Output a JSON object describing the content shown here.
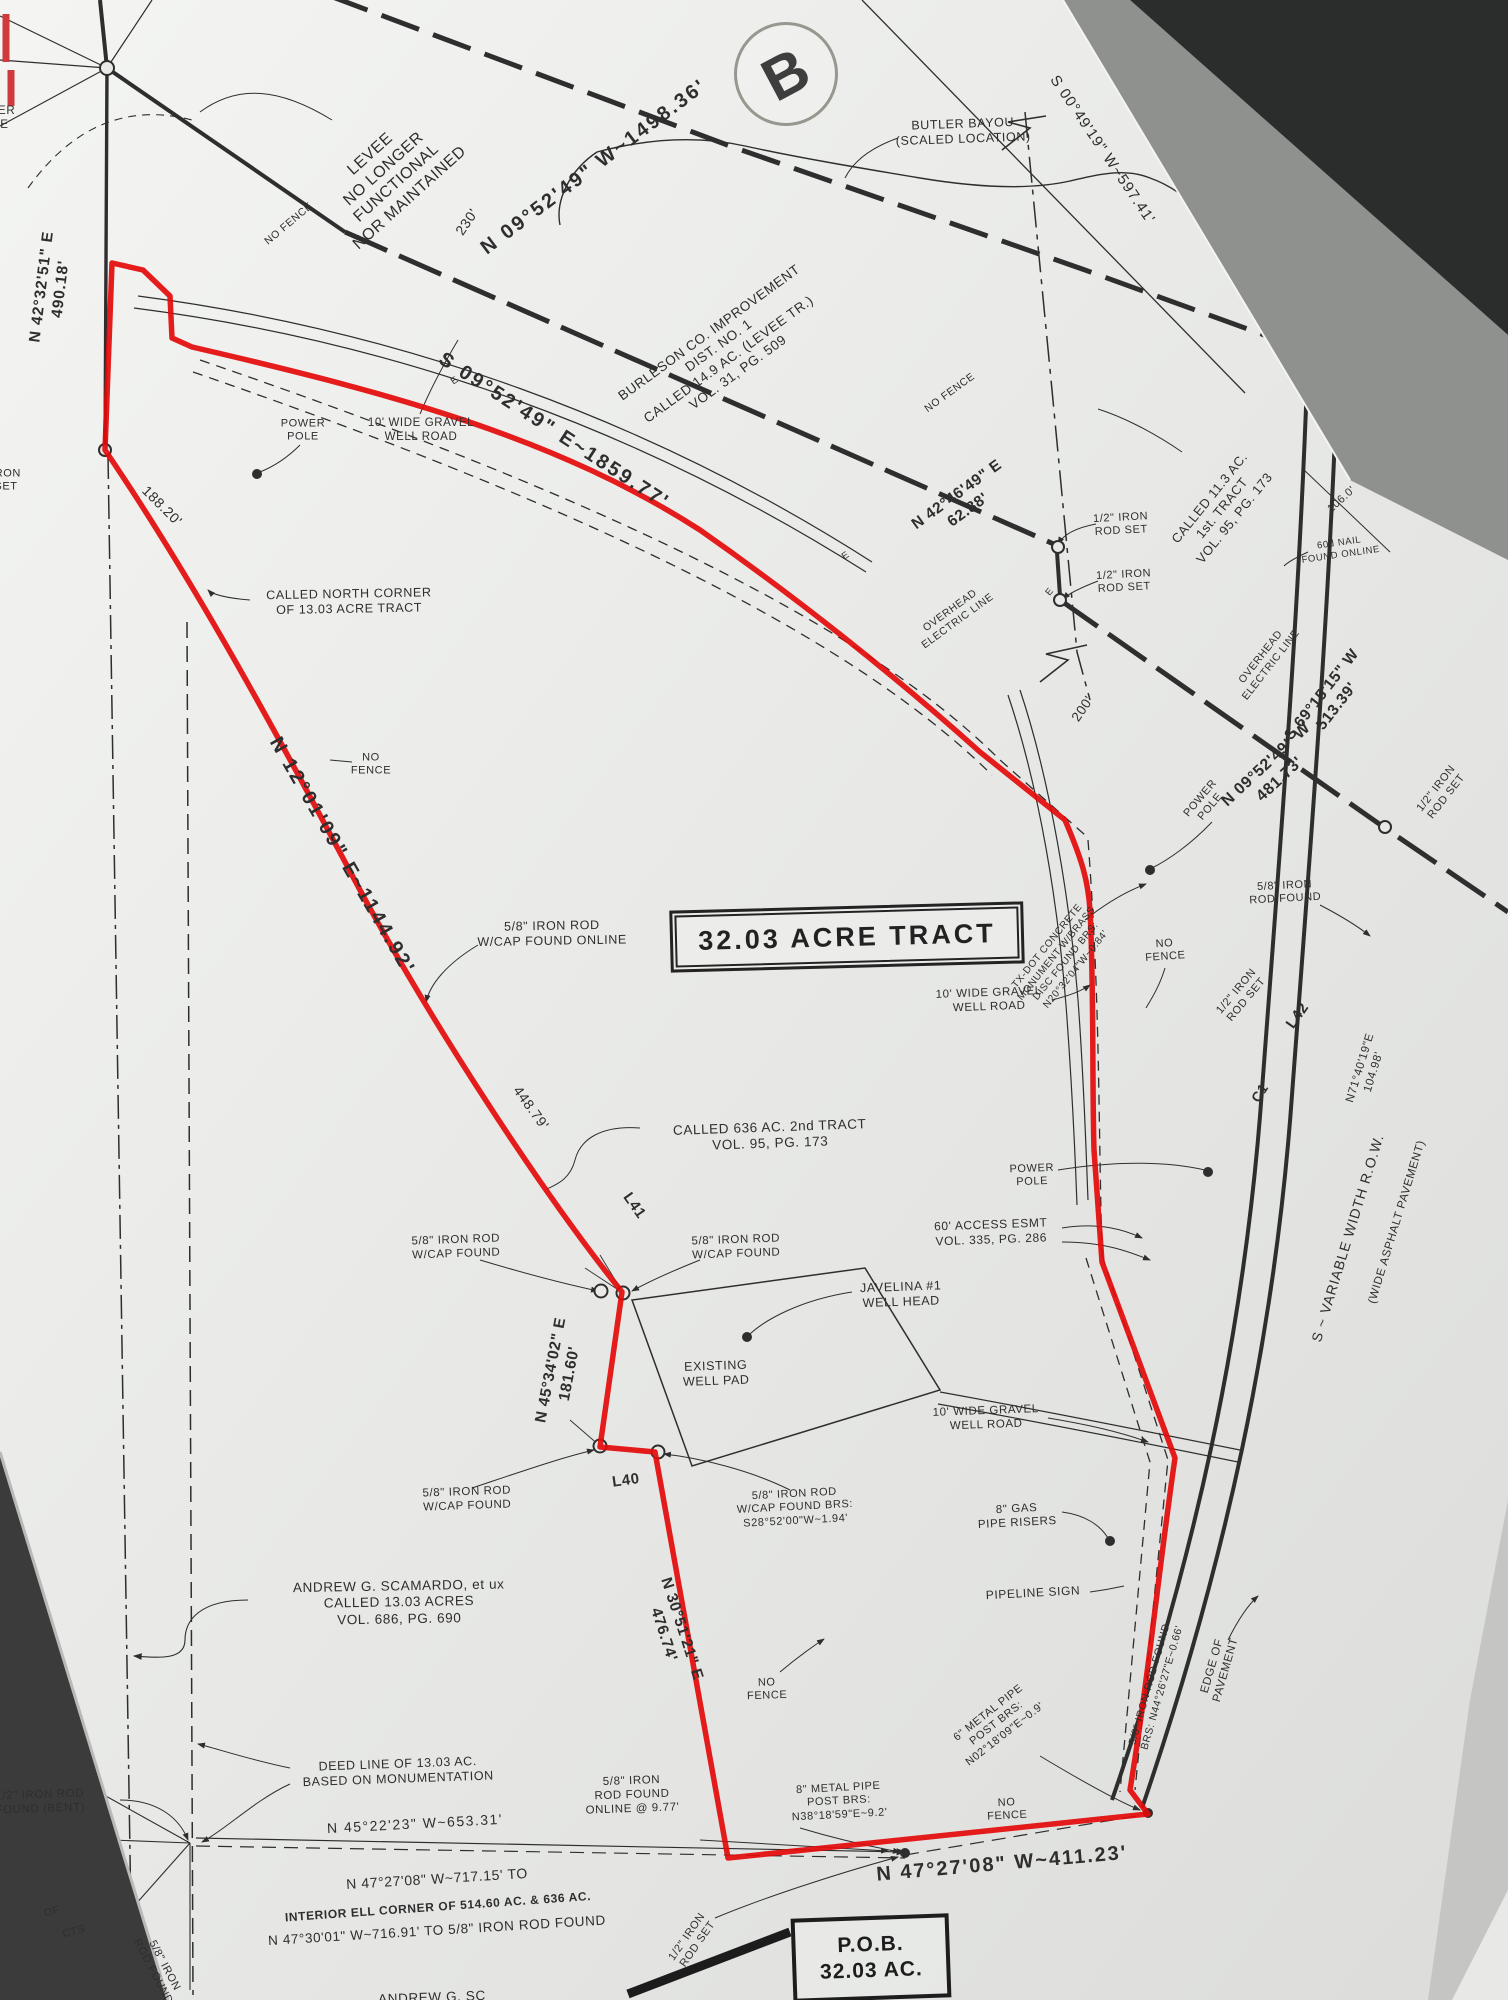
{
  "meta": {
    "kind": "scanned land survey plat photograph",
    "subject_tract": "32.03 ACRE TRACT"
  },
  "colors": {
    "paper": "#e9eae8",
    "ink": "#2e2e2e",
    "boundary_red": "#e40a0a",
    "background_dark": "#2b2c2c"
  },
  "boxes": {
    "tract_title": "32.03 ACRE TRACT",
    "pob_line1": "P.O.B.",
    "pob_line2": "32.03 AC.",
    "stamp": "B"
  },
  "labels": [
    {
      "name": "power-pole-clipped",
      "text": "POWER\nPOLE",
      "x": -8,
      "y": 118,
      "rot": 0,
      "size": 11.5
    },
    {
      "name": "bearing-n4232",
      "text": "N 42°32'51\" E\n490.18'",
      "x": 52,
      "y": 288,
      "rot": -83,
      "size": 15.5,
      "weight": 600,
      "ls": 1
    },
    {
      "name": "levee-note",
      "text": "LEVEE\nNO LONGER\nFUNCTIONAL\nNOR MAINTAINED",
      "x": 390,
      "y": 176,
      "rot": -42,
      "size": 16
    },
    {
      "name": "no-fence-1",
      "text": "NO FENCE",
      "x": 289,
      "y": 224,
      "rot": -40,
      "size": 10.5
    },
    {
      "name": "bearing-n0952-main",
      "text": "N 09°52'49\" W~1498.36'",
      "x": 594,
      "y": 167,
      "rot": -37,
      "size": 20,
      "weight": 600,
      "ls": 2.5
    },
    {
      "name": "dim-230",
      "text": "230'",
      "x": 467,
      "y": 222,
      "rot": -56,
      "size": 14
    },
    {
      "name": "butler-bayou",
      "text": "BUTLER BAYOU\n(SCALED LOCATION)",
      "x": 963,
      "y": 132,
      "rot": -2,
      "size": 12.5
    },
    {
      "name": "bearing-s0049",
      "text": "S 00°49'19\" W~597.41'",
      "x": 1102,
      "y": 150,
      "rot": 56,
      "size": 15,
      "ls": 1
    },
    {
      "name": "burleson-note",
      "text": "BURLESON CO. IMPROVEMENT\nDIST. NO. 1\nCALLED 14.9 AC. (LEVEE TR.)\nVOL. 31, PG. 509",
      "x": 724,
      "y": 353,
      "rot": -36,
      "size": 13.5
    },
    {
      "name": "no-fence-2",
      "text": "NO FENCE",
      "x": 950,
      "y": 393,
      "rot": -36,
      "size": 10.5
    },
    {
      "name": "bearing-n4246",
      "text": "N 42°46'49\" E\n62.88'",
      "x": 963,
      "y": 503,
      "rot": -36,
      "size": 15.5,
      "weight": 600
    },
    {
      "name": "overhead-electric-1",
      "text": "OVERHEAD\nELECTRIC LINE",
      "x": 954,
      "y": 616,
      "rot": -36,
      "size": 10.5
    },
    {
      "name": "bearing-s0952",
      "text": "S 09°52'49\" E~1859.77'",
      "x": 554,
      "y": 431,
      "rot": 33,
      "size": 20,
      "weight": 600,
      "ls": 2.5
    },
    {
      "name": "iron-rod-set-1",
      "text": "1/2\" IRON\nROD SET",
      "x": 1121,
      "y": 525,
      "rot": -3,
      "size": 11
    },
    {
      "name": "iron-rod-set-2",
      "text": "1/2\" IRON\nROD SET",
      "x": 1124,
      "y": 582,
      "rot": -3,
      "size": 11
    },
    {
      "name": "called-113",
      "text": "CALLED 11.3 AC.\n1st. TRACT\nVOL. 95, PG. 173",
      "x": 1222,
      "y": 508,
      "rot": -51,
      "size": 13
    },
    {
      "name": "nail-60d",
      "text": "60d NAIL\nFOUND ONLINE",
      "x": 1340,
      "y": 549,
      "rot": -8,
      "size": 9.5
    },
    {
      "name": "dim-106",
      "text": "106.0'",
      "x": 1342,
      "y": 500,
      "rot": -42,
      "size": 11
    },
    {
      "name": "bearing-s6915",
      "text": "S 69°15'15\" W\n513.39'",
      "x": 1330,
      "y": 701,
      "rot": -52,
      "size": 15.5,
      "weight": 600
    },
    {
      "name": "overhead-electric-2",
      "text": "OVERHEAD\nELECTRIC LINE",
      "x": 1266,
      "y": 661,
      "rot": -52,
      "size": 10.5
    },
    {
      "name": "dim-200",
      "text": "200'",
      "x": 1083,
      "y": 709,
      "rot": -56,
      "size": 13.5
    },
    {
      "name": "bearing-n0952-481",
      "text": "N 09°52'49\" W\n481.73'",
      "x": 1273,
      "y": 772,
      "rot": -43,
      "size": 16,
      "weight": 600
    },
    {
      "name": "power-pole-2",
      "text": "POWER\nPOLE",
      "x": 1206,
      "y": 803,
      "rot": -50,
      "size": 11
    },
    {
      "name": "iron-rod-found-58",
      "text": "5/8\" IRON\nROD FOUND",
      "x": 1285,
      "y": 893,
      "rot": -3,
      "size": 11
    },
    {
      "name": "iron-rod-set-l42",
      "text": "1/2\" IRON\nROD SET",
      "x": 1242,
      "y": 996,
      "rot": -50,
      "size": 11
    },
    {
      "name": "line-l42",
      "text": "L42",
      "x": 1298,
      "y": 1016,
      "rot": -55,
      "size": 15,
      "weight": 600
    },
    {
      "name": "iron-rod-set-edge",
      "text": "1/2\" IRON\nROD SET",
      "x": 1442,
      "y": 793,
      "rot": -52,
      "size": 11
    },
    {
      "name": "txdot-monument-note",
      "text": "TX-DOT CONCRETE\nMONUMENT W/BRASS\nDISC FOUND BRS:\nN20°32'04\"W~0.84'",
      "x": 1062,
      "y": 958,
      "rot": -51,
      "size": 10
    },
    {
      "name": "bearing-n7140",
      "text": "N71°40'19\"E\n104.98'",
      "x": 1367,
      "y": 1070,
      "rot": -73,
      "size": 11.5
    },
    {
      "name": "curve-c1",
      "text": "C1",
      "x": 1260,
      "y": 1093,
      "rot": -58,
      "size": 14,
      "weight": 600
    },
    {
      "name": "no-fence-right",
      "text": "NO\nFENCE",
      "x": 1165,
      "y": 951,
      "rot": -4,
      "size": 11
    },
    {
      "name": "power-pole-1",
      "text": "POWER\nPOLE",
      "x": 303,
      "y": 431,
      "rot": 0,
      "size": 11
    },
    {
      "name": "gravel-road-1",
      "text": "10' WIDE GRAVEL\nWELL ROAD",
      "x": 421,
      "y": 430,
      "rot": 0,
      "size": 11.5
    },
    {
      "name": "iron-set-left",
      "text": "IRON\nSET",
      "x": 6,
      "y": 481,
      "rot": 0,
      "size": 11
    },
    {
      "name": "dim-18820",
      "text": "188.20'",
      "x": 162,
      "y": 506,
      "rot": 45,
      "size": 14
    },
    {
      "name": "called-north-corner",
      "text": "CALLED NORTH CORNER\nOF 13.03 ACRE TRACT",
      "x": 349,
      "y": 602,
      "rot": -1,
      "size": 12.5
    },
    {
      "name": "no-fence-3",
      "text": "NO\nFENCE",
      "x": 371,
      "y": 765,
      "rot": 0,
      "size": 11
    },
    {
      "name": "bearing-n1201",
      "text": "N 12°01'09\" E~1144.92'",
      "x": 342,
      "y": 856,
      "rot": 60,
      "size": 20,
      "weight": 600,
      "ls": 2.5
    },
    {
      "name": "rod-cap-online",
      "text": "5/8\" IRON ROD\nW/CAP FOUND ONLINE",
      "x": 552,
      "y": 934,
      "rot": -1,
      "size": 12.5
    },
    {
      "name": "dim-44879",
      "text": "448.79'",
      "x": 531,
      "y": 1108,
      "rot": 54,
      "size": 14
    },
    {
      "name": "called-636",
      "text": "CALLED 636 AC. 2nd TRACT\nVOL. 95, PG. 173",
      "x": 770,
      "y": 1136,
      "rot": -2,
      "size": 13.5
    },
    {
      "name": "line-l41",
      "text": "L41",
      "x": 634,
      "y": 1206,
      "rot": 55,
      "size": 15,
      "weight": 600
    },
    {
      "name": "rod-cap-found-1",
      "text": "5/8\" IRON ROD\nW/CAP FOUND",
      "x": 456,
      "y": 1247,
      "rot": -2,
      "size": 11.5
    },
    {
      "name": "rod-cap-found-2",
      "text": "5/8\" IRON ROD\nW/CAP FOUND",
      "x": 736,
      "y": 1247,
      "rot": -2,
      "size": 11.5
    },
    {
      "name": "javelina-well-head",
      "text": "JAVELINA #1\nWELL HEAD",
      "x": 901,
      "y": 1295,
      "rot": -2,
      "size": 12.5
    },
    {
      "name": "power-pole-3",
      "text": "POWER\nPOLE",
      "x": 1032,
      "y": 1176,
      "rot": -2,
      "size": 11
    },
    {
      "name": "access-esmt",
      "text": "60' ACCESS ESMT\nVOL. 335, PG. 286",
      "x": 991,
      "y": 1232,
      "rot": -2,
      "size": 12
    },
    {
      "name": "bearing-n4534",
      "text": "N 45°34'02\" E\n181.60'",
      "x": 561,
      "y": 1372,
      "rot": -79,
      "size": 15.5,
      "weight": 600
    },
    {
      "name": "existing-well-pad",
      "text": "EXISTING\nWELL PAD",
      "x": 716,
      "y": 1374,
      "rot": -2,
      "size": 12.5
    },
    {
      "name": "gravel-road-2",
      "text": "10' WIDE GRAVEL\nWELL ROAD",
      "x": 989,
      "y": 1000,
      "rot": -2,
      "size": 11.5
    },
    {
      "name": "gravel-road-3",
      "text": "10' WIDE GRAVEL\nWELL ROAD",
      "x": 986,
      "y": 1418,
      "rot": -2,
      "size": 11.5
    },
    {
      "name": "line-l40",
      "text": "L40",
      "x": 626,
      "y": 1481,
      "rot": -8,
      "size": 15,
      "weight": 600
    },
    {
      "name": "rod-cap-found-3",
      "text": "5/8\" IRON ROD\nW/CAP FOUND",
      "x": 467,
      "y": 1499,
      "rot": -2,
      "size": 11.5
    },
    {
      "name": "rod-cap-found-brs",
      "text": "5/8\" IRON ROD\nW/CAP FOUND BRS:\nS28°52'00\"W~1.94'",
      "x": 795,
      "y": 1508,
      "rot": -3,
      "size": 11
    },
    {
      "name": "gas-pipe-risers",
      "text": "8\" GAS\nPIPE RISERS",
      "x": 1017,
      "y": 1516,
      "rot": -3,
      "size": 11.5
    },
    {
      "name": "pipeline-sign",
      "text": "PIPELINE SIGN",
      "x": 1033,
      "y": 1593,
      "rot": -3,
      "size": 12
    },
    {
      "name": "scamardo-note",
      "text": "ANDREW G. SCAMARDO, et ux\nCALLED 13.03 ACRES\nVOL. 686, PG. 690",
      "x": 399,
      "y": 1603,
      "rot": -1,
      "size": 13.5
    },
    {
      "name": "bearing-n3051",
      "text": "N 30°51'21\" E\n476.74'",
      "x": 672,
      "y": 1632,
      "rot": 72,
      "size": 15.5,
      "weight": 600
    },
    {
      "name": "no-fence-4",
      "text": "NO\nFENCE",
      "x": 767,
      "y": 1690,
      "rot": -2,
      "size": 11
    },
    {
      "name": "rod-found-brs",
      "text": "5/8\" IRON ROD FOUND\nBRS: N44°26'27\"E~0.66'",
      "x": 1156,
      "y": 1686,
      "rot": -74,
      "size": 10.5
    },
    {
      "name": "edge-of-pavement",
      "text": "EDGE OF\nPAVEMENT",
      "x": 1219,
      "y": 1668,
      "rot": -74,
      "size": 11.5
    },
    {
      "name": "metal-pipe-6",
      "text": "6\" METAL PIPE\nPOST BRS:\nN02°18'09\"E~0.9'",
      "x": 997,
      "y": 1724,
      "rot": -38,
      "size": 11
    },
    {
      "name": "no-fence-5",
      "text": "NO\nFENCE",
      "x": 1007,
      "y": 1810,
      "rot": -3,
      "size": 11
    },
    {
      "name": "deed-line-note",
      "text": "DEED LINE OF 13.03 AC.\nBASED ON MONUMENTATION",
      "x": 398,
      "y": 1772,
      "rot": -2,
      "size": 12.5
    },
    {
      "name": "rod-found-bent",
      "text": "1/2\" IRON ROD\nFOUND (BENT)",
      "x": 40,
      "y": 1802,
      "rot": -2,
      "size": 11.5
    },
    {
      "name": "bearing-n4522",
      "text": "N 45°22'23\" W~653.31'",
      "x": 415,
      "y": 1824,
      "rot": -3,
      "size": 14,
      "ls": 1.5
    },
    {
      "name": "rod-found-online-977",
      "text": "5/8\" IRON\nROD FOUND\nONLINE @ 9.77'",
      "x": 632,
      "y": 1795,
      "rot": -2,
      "size": 11.5
    },
    {
      "name": "metal-pipe-8",
      "text": "8\" METAL PIPE\nPOST BRS:\nN38°18'59\"E~9.2'",
      "x": 839,
      "y": 1802,
      "rot": -3,
      "size": 11
    },
    {
      "name": "bearing-n4727-411",
      "text": "N 47°27'08\" W~411.23'",
      "x": 1002,
      "y": 1864,
      "rot": -5,
      "size": 20,
      "weight": 600,
      "ls": 2
    },
    {
      "name": "bearing-n4727-717",
      "text": "N 47°27'08\" W~717.15' TO",
      "x": 437,
      "y": 1879,
      "rot": -3.5,
      "size": 14
    },
    {
      "name": "interior-ell-note",
      "text": "INTERIOR ELL CORNER OF 514.60 AC. & 636 AC.",
      "x": 438,
      "y": 1907,
      "rot": -4,
      "size": 12,
      "weight": 700
    },
    {
      "name": "bearing-n4730",
      "text": "N 47°30'01\" W~716.91' TO 5/8\" IRON ROD FOUND",
      "x": 437,
      "y": 1931,
      "rot": -3.5,
      "size": 13.5
    },
    {
      "name": "iron-rod-set-pob",
      "text": "1/2\" IRON\nROD SET",
      "x": 693,
      "y": 1941,
      "rot": -55,
      "size": 11
    },
    {
      "name": "row-note",
      "text": "S ~ VARIABLE WIDTH R.O.W.",
      "x": 1348,
      "y": 1238,
      "rot": -73,
      "size": 14,
      "ls": 1
    },
    {
      "name": "asphalt-note",
      "text": "(WIDE ASPHALT PAVEMENT)",
      "x": 1397,
      "y": 1222,
      "rot": -73,
      "size": 11.5
    },
    {
      "name": "andrew-fragment",
      "text": "ANDREW G. SC",
      "x": 432,
      "y": 1998,
      "rot": -2,
      "size": 13.5
    },
    {
      "name": "fragment-of",
      "text": "OF",
      "x": 52,
      "y": 1912,
      "rot": -15,
      "size": 10.5
    },
    {
      "name": "fragment-cts",
      "text": "CTS",
      "x": 74,
      "y": 1932,
      "rot": -15,
      "size": 10.5
    },
    {
      "name": "rod-found-bottom-left",
      "text": "5/8\" IRON\nROD FOUND",
      "x": 158,
      "y": 1969,
      "rot": 62,
      "size": 11
    },
    {
      "name": "e-mark-1",
      "text": "E",
      "x": 455,
      "y": 381,
      "rot": -35,
      "size": 9.5
    },
    {
      "name": "e-mark-2",
      "text": "E",
      "x": 846,
      "y": 556,
      "rot": -35,
      "size": 9.5
    },
    {
      "name": "e-mark-3",
      "text": "E",
      "x": 1050,
      "y": 592,
      "rot": -50,
      "size": 9.5
    }
  ]
}
